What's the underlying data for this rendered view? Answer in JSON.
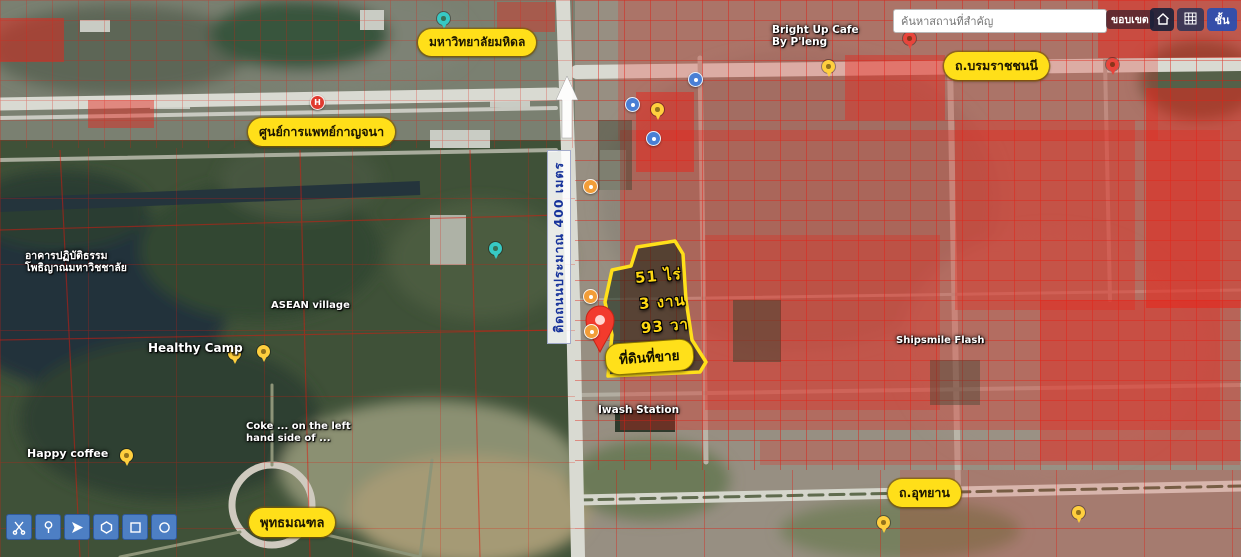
{
  "search": {
    "placeholder": "ค้นหาสถานที่สำคัญ",
    "btn_boundary": "ขอบเขต",
    "btn_layers": "ชั้น",
    "icons": [
      "home-icon",
      "grid-basemap-icon"
    ]
  },
  "property": {
    "area_lines": [
      "51 ไร่",
      "3 งาน",
      "93 วา"
    ],
    "sale_label": "ที่ดินที่ขาย",
    "outline_color": "#ffe01a"
  },
  "road_width_label": "ติดถนนประมาณ 400 เมตร",
  "pills": [
    {
      "name": "pill-mahidol-university",
      "text": "มหาวิทยาลัยมหิดล",
      "x": 418,
      "y": 29,
      "fs": 12
    },
    {
      "name": "pill-kanchana-medical-center",
      "text": "ศูนย์การแพทย์กาญจนา",
      "x": 248,
      "y": 118,
      "fs": 12.5
    },
    {
      "name": "pill-borommaratchachonnani-road",
      "text": "ถ.บรมราชชนนี",
      "x": 944,
      "y": 52,
      "fs": 12.5
    },
    {
      "name": "pill-utthayan-road",
      "text": "ถ.อุทยาน",
      "x": 888,
      "y": 479,
      "fs": 12.5
    },
    {
      "name": "pill-phutthamonthon",
      "text": "พุทธมณฑล",
      "x": 249,
      "y": 508,
      "fs": 13
    }
  ],
  "map_labels": [
    {
      "name": "label-bright-up-cafe",
      "text": "Bright Up Cafe\nBy P'leng",
      "x": 772,
      "y": 24,
      "fs": 10.5
    },
    {
      "name": "label-dhamma-practice-hall",
      "text": "อาคารปฏิบัติธรรม\nโพธิญาณมหาวิชชาลัย",
      "x": 25,
      "y": 250,
      "fs": 10.5
    },
    {
      "name": "label-asean-village",
      "text": "ASEAN village",
      "x": 271,
      "y": 300,
      "fs": 10
    },
    {
      "name": "label-healthy-camp",
      "text": "Healthy Camp",
      "x": 148,
      "y": 341,
      "fs": 12
    },
    {
      "name": "label-happy-coffee",
      "text": "Happy coffee",
      "x": 27,
      "y": 448,
      "fs": 11
    },
    {
      "name": "label-coke-left-hand-side",
      "text": "Coke ... on the left\nhand side of ...",
      "x": 246,
      "y": 421,
      "fs": 10
    },
    {
      "name": "label-iwash-station",
      "text": "Iwash Station",
      "x": 598,
      "y": 404,
      "fs": 10.5
    },
    {
      "name": "label-shipsmile-flash",
      "text": "Shipsmile Flash",
      "x": 896,
      "y": 335,
      "fs": 10
    }
  ],
  "poi": [
    {
      "name": "poi-pin-yellow-1",
      "type": "pin",
      "color": "#ffcf3e",
      "x": 651,
      "y": 103
    },
    {
      "name": "poi-pin-yellow-2",
      "type": "pin",
      "color": "#ffcf3e",
      "x": 822,
      "y": 60
    },
    {
      "name": "poi-pin-yellow-3",
      "type": "pin",
      "color": "#ffcf3e",
      "x": 120,
      "y": 449
    },
    {
      "name": "poi-pin-yellow-4",
      "type": "pin",
      "color": "#ffcf3e",
      "x": 228,
      "y": 347
    },
    {
      "name": "poi-pin-yellow-5",
      "type": "pin",
      "color": "#ffcf3e",
      "x": 257,
      "y": 345
    },
    {
      "name": "poi-pin-yellow-6",
      "type": "pin",
      "color": "#ffcf3e",
      "x": 877,
      "y": 516
    },
    {
      "name": "poi-pin-yellow-7",
      "type": "pin",
      "color": "#ffcf3e",
      "x": 1072,
      "y": 506
    },
    {
      "name": "poi-pin-red-1",
      "type": "pin",
      "color": "#e8453c",
      "x": 1106,
      "y": 58
    },
    {
      "name": "poi-pin-red-2",
      "type": "pin",
      "color": "#e8453c",
      "x": 903,
      "y": 32
    },
    {
      "name": "poi-pin-teal-1",
      "type": "pin",
      "color": "#37c9c4",
      "x": 437,
      "y": 12
    },
    {
      "name": "poi-pin-teal-2",
      "type": "pin",
      "color": "#37c9c4",
      "x": 489,
      "y": 242
    },
    {
      "name": "poi-fuel-icon-1",
      "type": "circle",
      "color": "#f29d38",
      "x": 583,
      "y": 179
    },
    {
      "name": "poi-fuel-icon-2",
      "type": "circle",
      "color": "#f29d38",
      "x": 583,
      "y": 289
    },
    {
      "name": "poi-fuel-icon-3",
      "type": "circle",
      "color": "#f29d38",
      "x": 584,
      "y": 324
    },
    {
      "name": "poi-transit-icon-1",
      "type": "circle",
      "color": "#4a7fd4",
      "x": 625,
      "y": 97
    },
    {
      "name": "poi-transit-icon-2",
      "type": "circle",
      "color": "#4a7fd4",
      "x": 688,
      "y": 72
    },
    {
      "name": "poi-transit-icon-3",
      "type": "circle",
      "color": "#4a7fd4",
      "x": 646,
      "y": 131
    },
    {
      "name": "poi-hospital-icon",
      "type": "circle",
      "color": "#e03a2f",
      "x": 310,
      "y": 95,
      "glyph": "H"
    }
  ],
  "toolbar": {
    "tools": [
      {
        "name": "tool-scissors-button",
        "icon": "scissors-icon"
      },
      {
        "name": "tool-marker-button",
        "icon": "marker-pin-icon"
      },
      {
        "name": "tool-pan-button",
        "icon": "paper-plane-icon"
      },
      {
        "name": "tool-polygon-button",
        "icon": "polygon-icon"
      },
      {
        "name": "tool-rectangle-button",
        "icon": "rectangle-icon"
      },
      {
        "name": "tool-circle-button",
        "icon": "circle-icon"
      }
    ]
  },
  "colors": {
    "annotation_yellow": "#ffdf19",
    "parcel_red": "#e8241a",
    "toolbar_blue": "#4d7fc4",
    "marker_pin_red": "#f23b2d"
  }
}
